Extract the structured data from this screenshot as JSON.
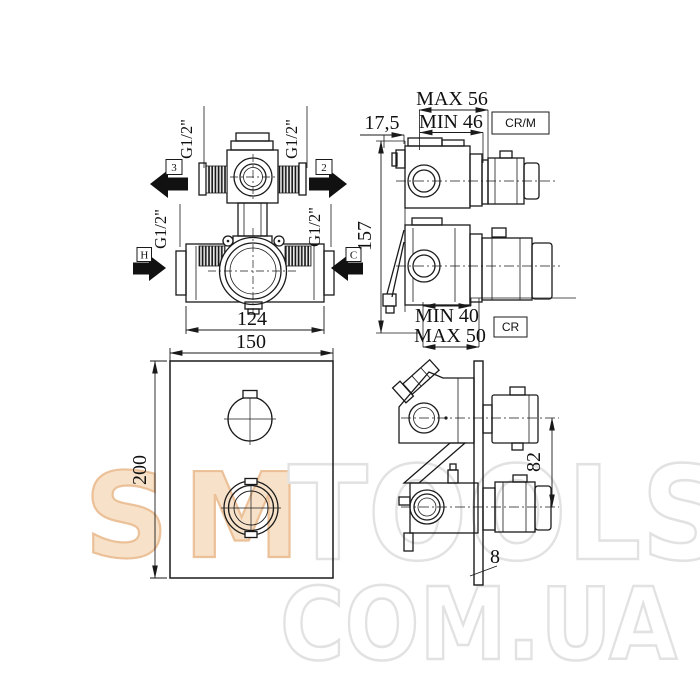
{
  "watermark": {
    "brand_left": "SM",
    "brand_right": "TOOLS",
    "domain": "COM.UA",
    "orange_fill": "#f7e0c6",
    "orange_stroke": "#e9b98c",
    "gray_stroke": "#e2e2e2"
  },
  "front_view": {
    "thread_size": "G1/2\"",
    "outlet_3": "3",
    "outlet_2": "2",
    "inlet_hot": "H",
    "inlet_cold": "C",
    "port_spacing": "124"
  },
  "plate_view": {
    "width": "150",
    "height": "200"
  },
  "side_view": {
    "wall_offset": "17,5",
    "body_height": "157",
    "top_depth_max": "MAX 56",
    "top_depth_min": "MIN 46",
    "top_finish_code": "CR/M",
    "bottom_depth_min": "MIN 40",
    "bottom_depth_max": "MAX 50",
    "bottom_finish_code": "CR"
  },
  "installed_view": {
    "handle_spacing": "82",
    "plate_thickness": "8"
  },
  "colors": {
    "line": "#1a1a1a"
  }
}
